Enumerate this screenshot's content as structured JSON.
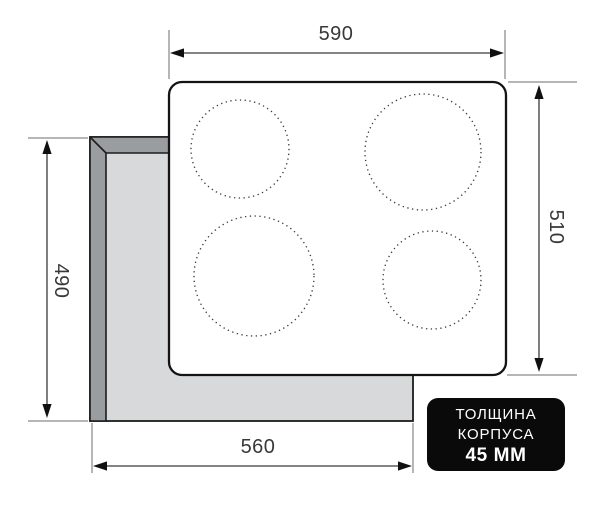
{
  "diagram": {
    "dimensions": {
      "hob_width_top": "590",
      "hob_height_right": "510",
      "cutout_height_left": "490",
      "cutout_width_bottom": "560"
    },
    "badge": {
      "line1": "ТОЛЩИНА",
      "line2": "КОРПУСА",
      "line3": "45 ММ"
    },
    "burner_count": 4,
    "colors": {
      "background": "#ffffff",
      "cutout_edge_band": "#9a9da0",
      "cutout_face": "#d8d9da",
      "outline": "#1c1c1c",
      "dimension_line": "#3a3a3a",
      "extension_line": "#6e6e6e",
      "label_text": "#383838",
      "badge_background": "#0a0a0a",
      "badge_text": "#ffffff"
    }
  }
}
